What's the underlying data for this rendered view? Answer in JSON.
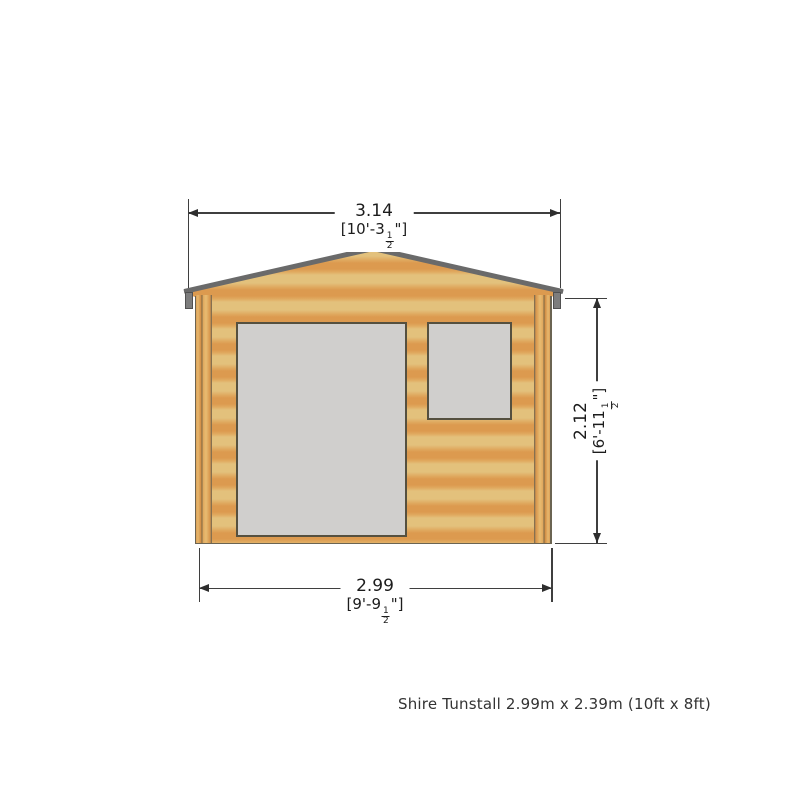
{
  "diagram": {
    "type": "front-elevation-drawing",
    "dimensions": {
      "overall_width": {
        "metric": "3.14",
        "imperial_prefix": "[10'-3",
        "fraction_numerator": "1",
        "fraction_denominator": "2",
        "imperial_suffix": "\"]"
      },
      "base_width": {
        "metric": "2.99",
        "imperial_prefix": "[9'-9",
        "fraction_numerator": "1",
        "fraction_denominator": "2",
        "imperial_suffix": "\"]"
      },
      "wall_height": {
        "metric": "2.12",
        "imperial_prefix": "[6'-11",
        "fraction_numerator": "1",
        "fraction_denominator": "2",
        "imperial_suffix": "\"]"
      }
    },
    "colors": {
      "wood_light": "#e3c17c",
      "wood_dark": "#dc9a4f",
      "roof_edge": "#6a6a6a",
      "eave_cap": "#7d7d7d",
      "opening_fill": "#d0cfcd",
      "opening_outline": "#55503f",
      "dimension_line": "#3f3f3f",
      "text": "#1c1c1c",
      "background": "#ffffff"
    }
  },
  "caption": {
    "text": "Shire Tunstall 2.99m x 2.39m (10ft x 8ft)"
  }
}
